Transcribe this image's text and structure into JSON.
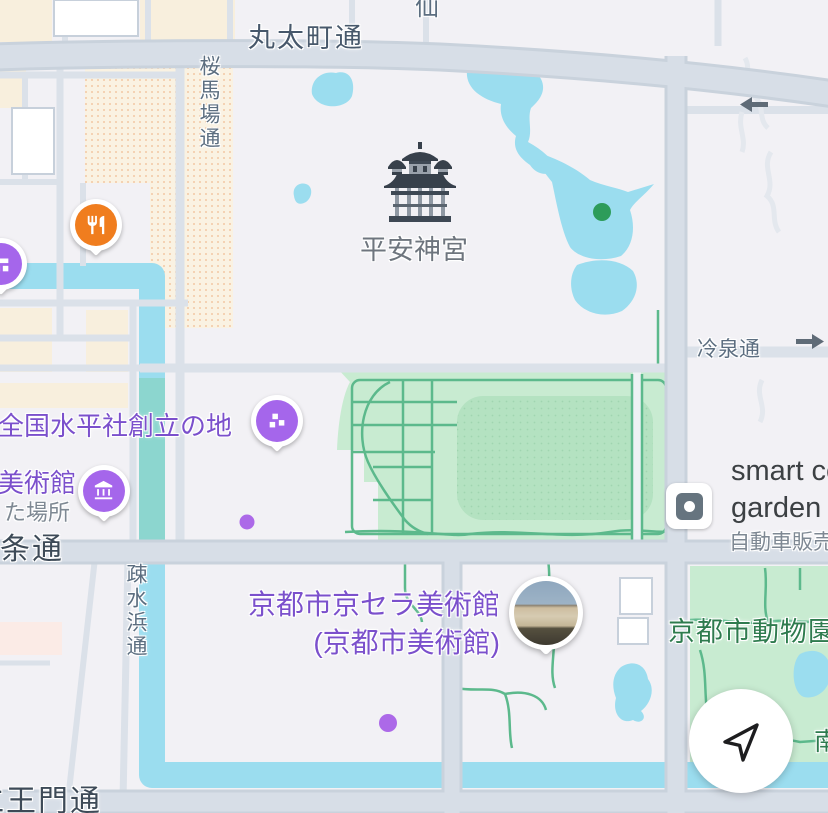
{
  "map_labels": {
    "roads": {
      "marutamachi": "丸太町通",
      "sen_partial": "仙",
      "sakurababa": "桜馬場通",
      "reisen": "冷泉通",
      "nijo": "二条通",
      "niomon": "仁王門通",
      "sosuihama": "疎水浜通"
    },
    "pois": {
      "heian_jingu": "平安神宮",
      "suiheisha": "全国水平社創立の地",
      "bijutsukan_partial": "美術館",
      "ta_basho_partial": "た場所",
      "kyocera_line1": "京都市京セラ美術館",
      "kyocera_line2": "(京都市美術館)",
      "zoo": "京都市動物園",
      "smart_line1": "smart ce",
      "smart_line2": "garden",
      "car_dealer_partial": "自動車販売",
      "minami_partial": "南"
    }
  },
  "icons": {
    "restaurant_pin": "fork-knife",
    "landmark_pin": "historic-site-squares",
    "museum_pin": "bank-columns",
    "edge_pin": "monument-blocks",
    "photo_pin": "museum-photo-circle",
    "shrine": "shrine-building",
    "square_poi": "building-square-dot",
    "navigate": "navigation-arrow",
    "one_way_left": "left-arrow",
    "one_way_right": "right-arrow",
    "green_dot": "garden-poi-dot",
    "purple_dot": "minor-poi-dot"
  },
  "colors": {
    "background": "#F2F1F5",
    "water": "#9BDDEF",
    "water_teal": "#8CD6CF",
    "park": "#C8EBD1",
    "field": "#B4E2C1",
    "path_green": "#5CB98C",
    "road_fill": "#D7DEE7",
    "road_casing": "#C9D2DC",
    "beige": "#F8EFDD",
    "pin_orange": "#F07D1E",
    "pin_purple": "#A566EB",
    "text_purple": "#7B50CC",
    "text_green": "#2E7B4E",
    "text_dark": "#3C4043"
  }
}
